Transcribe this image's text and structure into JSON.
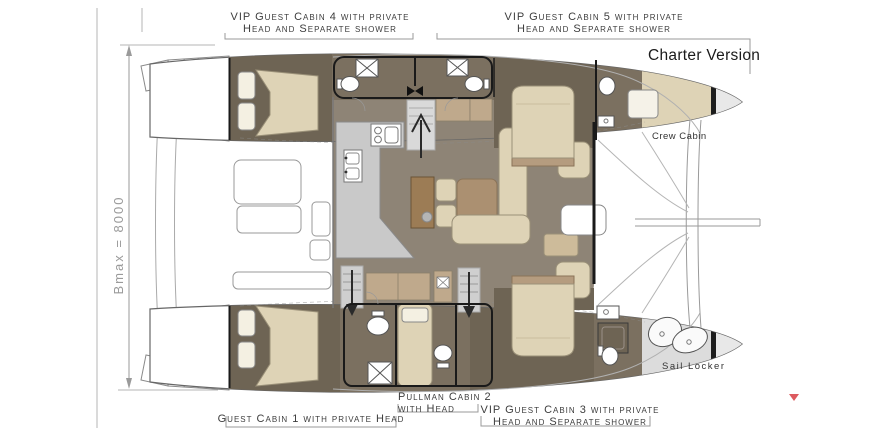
{
  "title": "Charter Version",
  "labels": {
    "charter_version": "Charter Version",
    "cabin4": {
      "line1": "VIP Guest Cabin 4 with private",
      "line2": "Head and Separate shower"
    },
    "cabin5": {
      "line1": "VIP Guest Cabin 5 with private",
      "line2": "Head and Separate shower"
    },
    "cabin1": {
      "line1": "Guest Cabin 1 with private Head"
    },
    "cabin2": {
      "line1": "Pullman Cabin 2",
      "line2": "with Head"
    },
    "cabin3": {
      "line1": "VIP Guest Cabin 3 with private",
      "line2": "Head and Separate shower"
    },
    "crew_cabin": "Crew Cabin",
    "sail_locker": "Sail Locker",
    "beam_dimension": "Bmax = 8000"
  },
  "colors": {
    "saloon_floor": "#8e8476",
    "cabin_floor": "#6e6454",
    "head_floor": "#7b7060",
    "mattress_beige": "#ded3b6",
    "cushion_tan": "#b59c7f",
    "cabinet_tan": "#bfa98c",
    "counter_gray": "#c9c9c9",
    "locker_gray": "#dcdcdc",
    "bulkhead_black": "#1d1d1d",
    "outline_gray": "#8a8a8a",
    "label_text": "#3d3d3d",
    "dimension_text": "#9a9a9a",
    "marker_red": "#dd5a5f"
  }
}
